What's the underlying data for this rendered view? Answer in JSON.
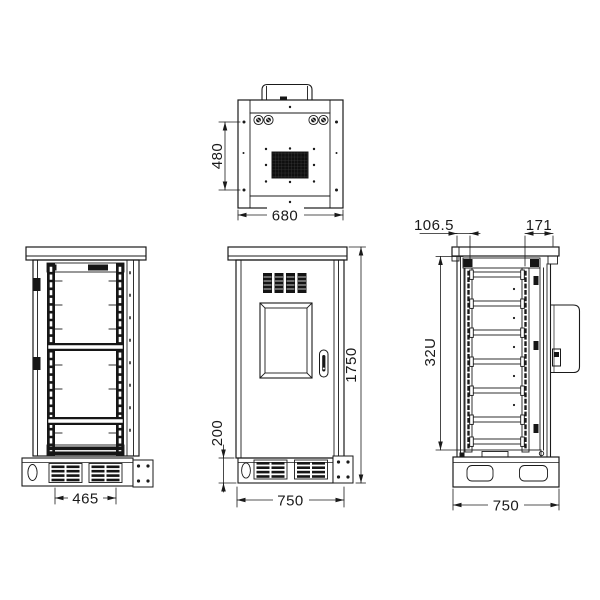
{
  "drawing": {
    "background_color": "#ffffff",
    "line_color": "#1a1a1a",
    "fill_dark": "#161616",
    "views": {
      "top": {
        "name": "top-view",
        "dims": {
          "depth": "480",
          "width": "680"
        }
      },
      "front_open": {
        "name": "front-open-view",
        "dims": {
          "rack_width": "465"
        }
      },
      "front": {
        "name": "front-view",
        "dims": {
          "height": "1750",
          "base_height": "200",
          "width": "750"
        }
      },
      "side": {
        "name": "side-view",
        "dims": {
          "back_offset": "106.5",
          "front_offset": "171",
          "rack_units": "32U",
          "width": "750"
        }
      }
    }
  }
}
